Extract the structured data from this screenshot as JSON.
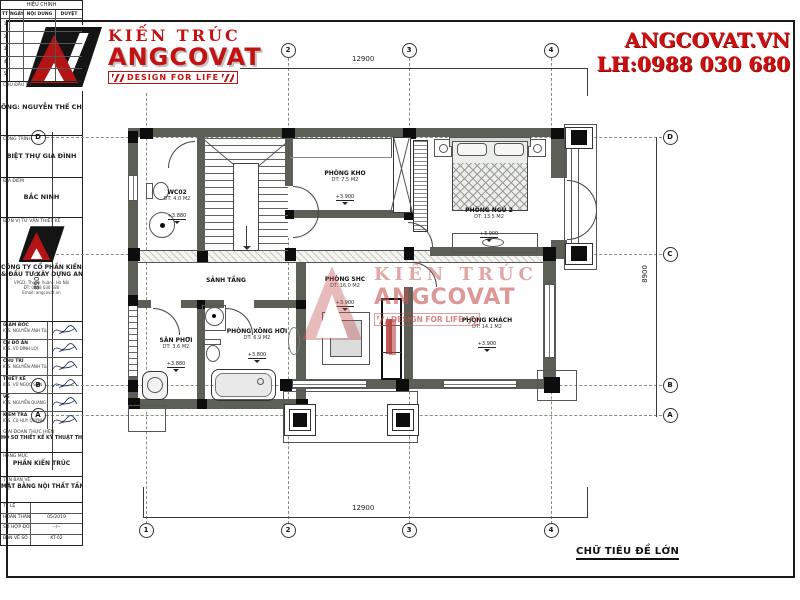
{
  "branding": {
    "title": "KIẾN TRÚC",
    "name": "ANGCOVAT",
    "tagline": "DESIGN FOR LIFE",
    "website": "ANGCOVAT.VN",
    "phone": "LH:0988 030 680",
    "accent_color": "#c41212"
  },
  "watermark": {
    "line1": "KIẾN TRÚC",
    "line2": "ANGCOVAT",
    "line3": "DESIGN FOR LIFE"
  },
  "drawing": {
    "caption": "CHỮ TIÊU ĐỀ LỚN",
    "dims": {
      "top": "12900",
      "bottom": "12900",
      "left": "8900",
      "right": "8900"
    },
    "grid": {
      "cols": [
        "1",
        "2",
        "3",
        "4"
      ],
      "rows": [
        "D",
        "C",
        "B",
        "A"
      ]
    },
    "rooms": [
      {
        "name": "WC02",
        "area": "DT: 4.0 M2",
        "level": "+3.880",
        "x": 177,
        "y": 189
      },
      {
        "name": "PHÒNG KHO",
        "area": "DT: 7.5 M2",
        "level": "+3.900",
        "x": 345,
        "y": 170
      },
      {
        "name": "PHÒNG NGỦ 2",
        "area": "DT: 13.5 M2",
        "level": "+3.900",
        "x": 489,
        "y": 207
      },
      {
        "name": "SẢNH TẦNG",
        "area": "",
        "level": "",
        "x": 226,
        "y": 277
      },
      {
        "name": "PHÒNG SHC",
        "area": "DT: 16.0 M2",
        "level": "+3.900",
        "x": 345,
        "y": 276
      },
      {
        "name": "PHÒNG KHÁCH",
        "area": "DT: 14.1 M2",
        "level": "+3.900",
        "x": 487,
        "y": 317
      },
      {
        "name": "SÂN PHƠI",
        "area": "DT: 3.6 M2",
        "level": "+3.880",
        "x": 176,
        "y": 337
      },
      {
        "name": "PHÒNG XÔNG HƠI",
        "area": "DT: 6.9 M2",
        "level": "+3.800",
        "x": 257,
        "y": 328
      }
    ]
  },
  "titleblock": {
    "revision": {
      "title": "HIỆU CHỈNH",
      "cols": [
        "TT",
        "NGÀY",
        "NỘI DUNG",
        "DUYỆT"
      ],
      "rows": [
        "1",
        "2",
        "3",
        "4",
        "5"
      ]
    },
    "investor": {
      "label": "CHỦ ĐẦU TƯ",
      "value": "ÔNG: NGUYỄN THẾ CHUNG"
    },
    "project": {
      "label": "CÔNG TRÌNH",
      "value": "BIỆT THỰ GIA ĐÌNH"
    },
    "location": {
      "label": "ĐỊA ĐIỂM",
      "value": "BẮC NINH"
    },
    "consultant": {
      "label": "ĐƠN VỊ TƯ VẤN THIẾT KẾ",
      "company1": "CÔNG TY CỔ PHẦN KIẾN TRÚC",
      "company2": "& ĐẦU TƯ XÂY DỰNG ANG",
      "addr1": "VPGD: Thanh Xuân - Hà Nội",
      "addr2": "ĐT: 0988 030 680",
      "addr3": "Email: angcovat.vn"
    },
    "signers": [
      {
        "role": "GIÁM ĐỐC",
        "name": "KTS. NGUYỄN ANH TUẤN"
      },
      {
        "role": "CN ĐỒ ÁN",
        "name": "KTS. VŨ ĐÌNH LỢI"
      },
      {
        "role": "CHỦ TRÌ",
        "name": "KTS. NGUYỄN ANH TUẤN"
      },
      {
        "role": "THIẾT KẾ",
        "name": "KTS. VŨ NGỌC SƠN"
      },
      {
        "role": "VẼ",
        "name": "KTS. NGUYỄN QUANG THÁI"
      },
      {
        "role": "KIỂM TRA",
        "name": "KTS. CÙ HUY QUỲNH"
      }
    ],
    "stage": {
      "label": "GIAI ĐOẠN THỰC HIỆN",
      "value": "HỒ SƠ THIẾT KẾ KỸ THUẬT THI CÔNG"
    },
    "category": {
      "label": "HẠNG MỤC",
      "value": "PHẦN KIẾN TRÚC"
    },
    "sheet": {
      "label": "TÊN BẢN VẼ",
      "value": "MẶT BẰNG NỘI THẤT TẦNG 1"
    },
    "info": [
      {
        "label": "TỶ LỆ",
        "value": ""
      },
      {
        "label": "HOÀN THÀNH",
        "value": "05/2019"
      },
      {
        "label": "SỐ HỢP ĐỒNG",
        "value": "--/--"
      },
      {
        "label": "BẢN VẼ SỐ",
        "value": "KT-02"
      }
    ]
  }
}
